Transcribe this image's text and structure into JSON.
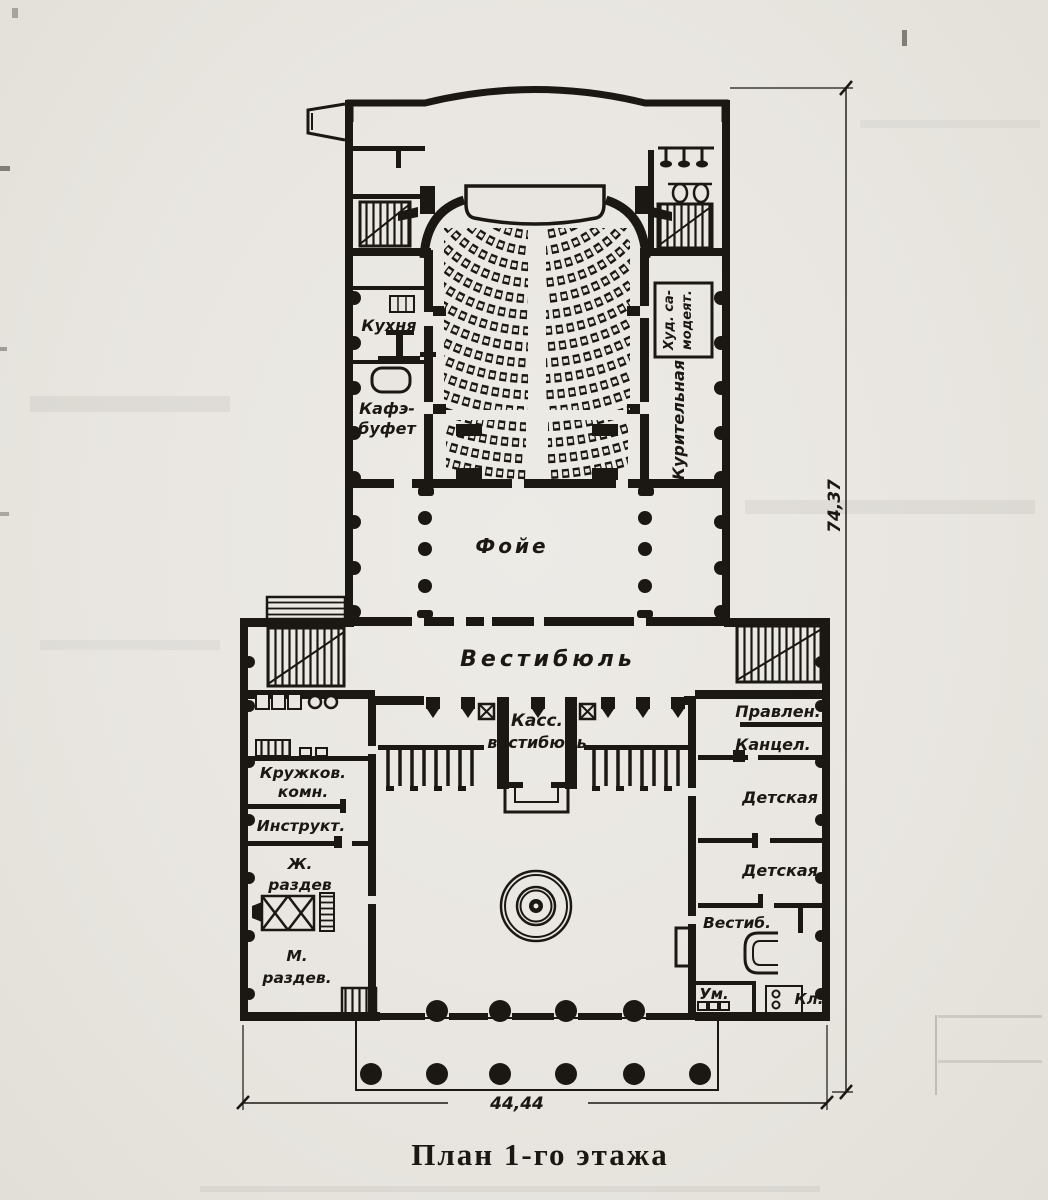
{
  "drawing": {
    "title": "План 1-го этажа",
    "paper_color": "#e9e6e1",
    "ink_color": "#1b1713"
  },
  "dimensions": {
    "height_label": "74,37",
    "width_label": "44,44"
  },
  "rooms": {
    "kitchen": "Кухня",
    "cafe_line1": "Кафэ-",
    "cafe_line2": "буфет",
    "art_line1": "Худ. са-",
    "art_line2": "модеят.",
    "smoking": "Курительная",
    "foyer": "Фойе",
    "vestibule": "Вестибюль",
    "cash_line1": "Касс.",
    "cash_line2": "вестибюль",
    "board": "Правлен.",
    "office": "Канцел.",
    "children_1": "Детская",
    "children_2": "Детская",
    "small_vestibule": "Вестиб.",
    "washroom": "Ум.",
    "closet": "Кл.",
    "club_line1": "Кружков.",
    "club_line2": "комн.",
    "instructor": "Инструкт.",
    "women_line1": "Ж.",
    "women_line2": "раздев",
    "men_line1": "М.",
    "men_line2": "раздев."
  }
}
